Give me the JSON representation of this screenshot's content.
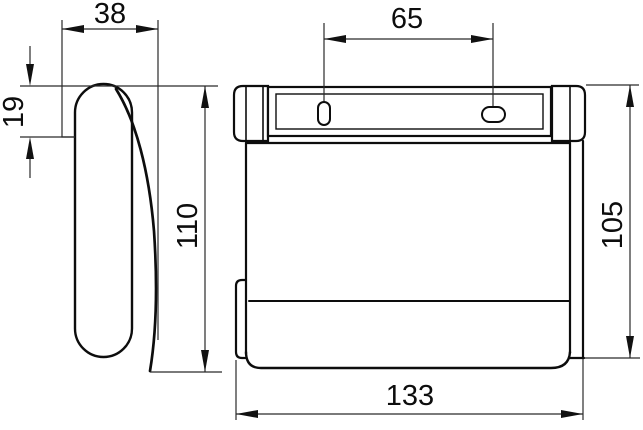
{
  "drawing": {
    "background": "#ffffff",
    "line_color": "#0d0d0d",
    "views": {
      "side": {
        "label": "side-view",
        "dims": {
          "depth": "38",
          "bracket_height": "19",
          "height": "110"
        }
      },
      "front": {
        "label": "front-view",
        "dims": {
          "hole_spacing": "65",
          "height": "105",
          "width": "133"
        }
      }
    }
  }
}
